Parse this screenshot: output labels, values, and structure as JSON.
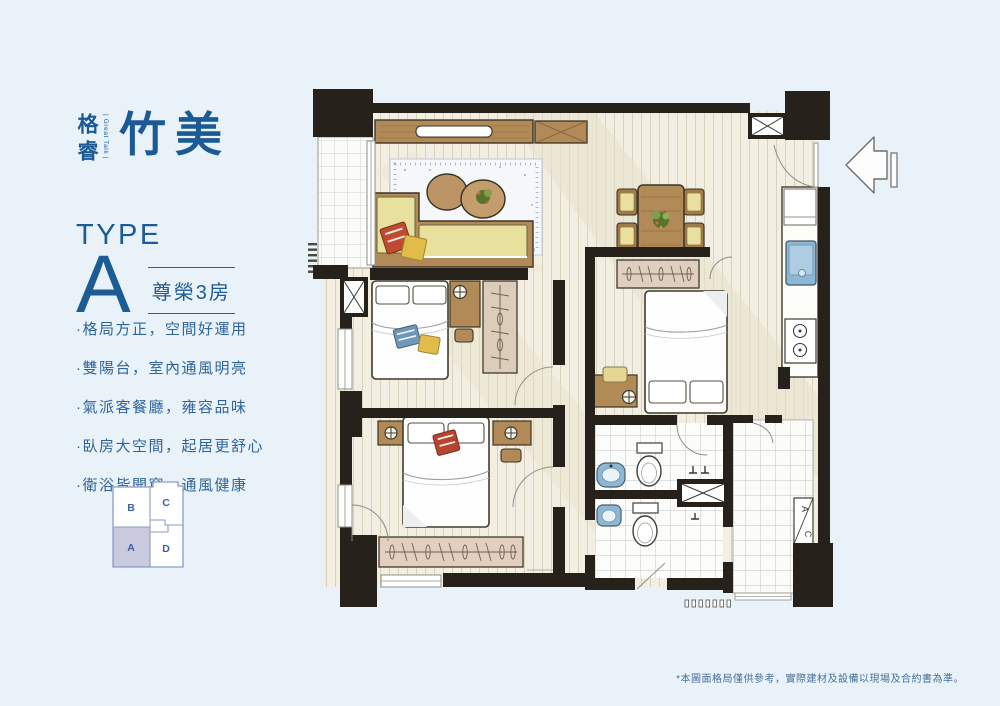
{
  "brand": {
    "name_vertical": "格睿",
    "tagline": "| Great Talk |",
    "name_main": "竹美"
  },
  "type_block": {
    "label": "TYPE",
    "letter": "A",
    "badge": "尊榮3房"
  },
  "features": [
    "·格局方正，空間好運用",
    "·雙陽台，室內通風明亮",
    "·氣派客餐廳，雍容品味",
    "·臥房大空間，起居更舒心",
    "·衛浴皆開窗，通風健康"
  ],
  "key_plan": {
    "units": [
      "B",
      "C",
      "A",
      "D"
    ],
    "highlighted_unit": "A"
  },
  "floor_plan": {
    "ac_label": [
      "A",
      "C"
    ]
  },
  "disclaimer": "*本圖面格局僅供參考，實際建材及設備以現場及合約書為準。",
  "colors": {
    "background": "#e9f2f9",
    "brand_blue": "#1c5a96",
    "accent_blue": "#2a6097",
    "wall": "#26211a",
    "wood": "#b28a58",
    "sofa": "#e7e19d",
    "fixture_blue": "#8db7d5",
    "floor": "#f2eee2",
    "keyplan_highlight": "#c9cade"
  }
}
